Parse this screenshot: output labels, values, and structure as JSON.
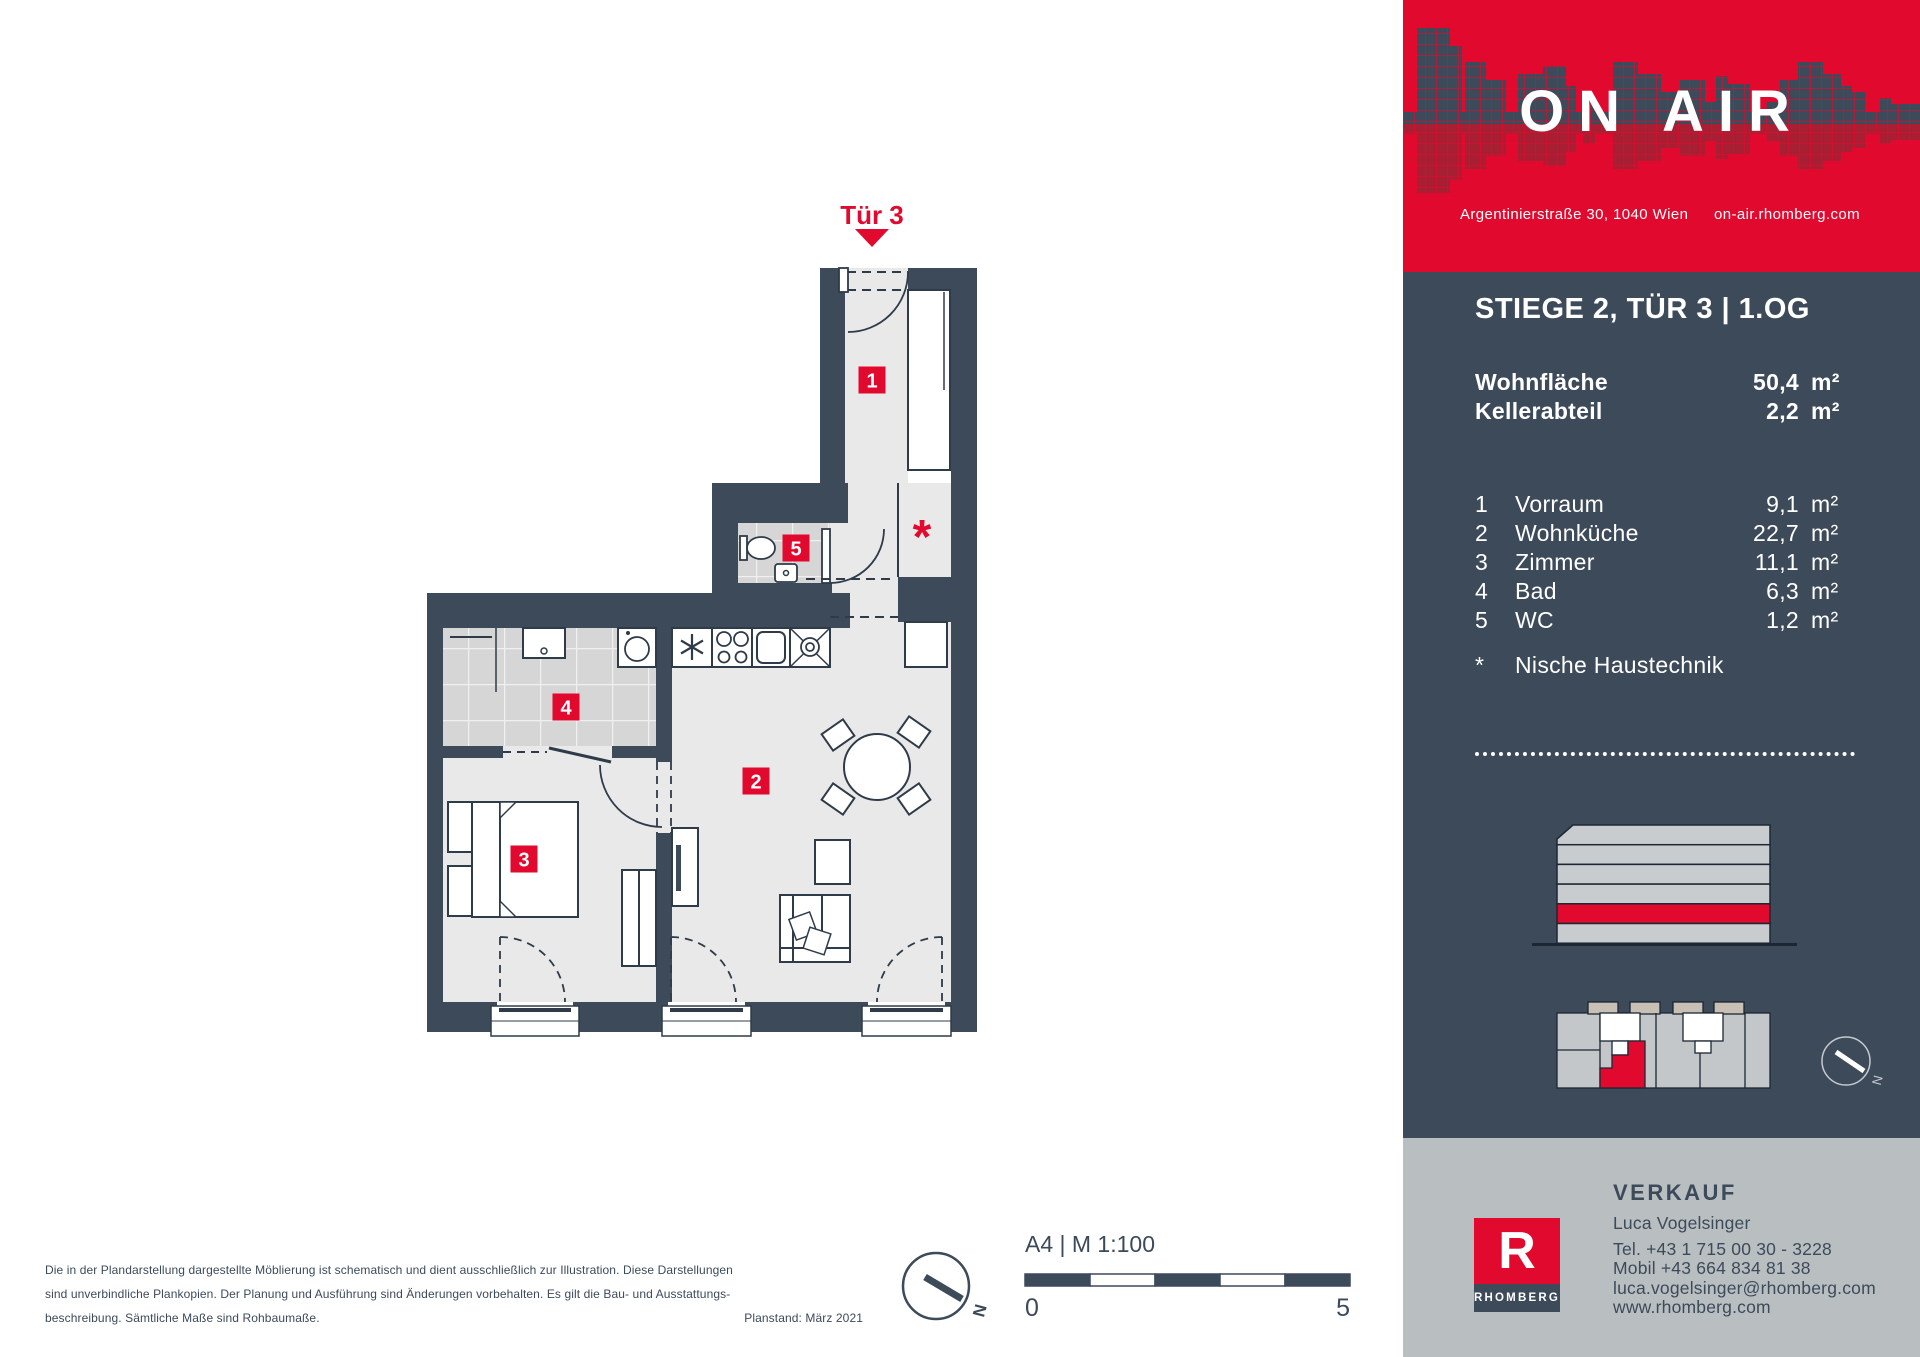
{
  "colors": {
    "accent_red": "#e2092e",
    "navy": "#3d4a5a",
    "reflection_red": "#a81f33",
    "floor_gray": "#e9e9e9",
    "tile_gray": "#d6d6d6",
    "footer_gray": "#b9bec1"
  },
  "header": {
    "brand": "ON AIR",
    "address": "Argentinierstraße 30, 1040 Wien",
    "website": "on-air.rhomberg.com"
  },
  "unit": {
    "title": "STIEGE 2, TÜR 3 | 1.OG",
    "summary": [
      {
        "label": "Wohnfläche",
        "value": "50,4",
        "unit": "m²"
      },
      {
        "label": "Kellerabteil",
        "value": "2,2",
        "unit": "m²"
      }
    ],
    "rooms": [
      {
        "nr": "1",
        "name": "Vorraum",
        "value": "9,1",
        "unit": "m²"
      },
      {
        "nr": "2",
        "name": "Wohnküche",
        "value": "22,7",
        "unit": "m²"
      },
      {
        "nr": "3",
        "name": "Zimmer",
        "value": "11,1",
        "unit": "m²"
      },
      {
        "nr": "4",
        "name": "Bad",
        "value": "6,3",
        "unit": "m²"
      },
      {
        "nr": "5",
        "name": "WC",
        "value": "1,2",
        "unit": "m²"
      }
    ],
    "note": {
      "symbol": "*",
      "text": "Nische Haustechnik"
    }
  },
  "plan": {
    "entrance_label": "Tür 3",
    "labels": {
      "room1": "1",
      "room2": "2",
      "room3": "3",
      "room4": "4",
      "room5": "5"
    },
    "niche_symbol": "*",
    "compass_label": "N"
  },
  "scalebar": {
    "title": "A4 | M 1:100",
    "start": "0",
    "end": "5"
  },
  "disclaimer": {
    "line1": "Die in der Plandarstellung dargestellte Möblierung ist schematisch und dient ausschließlich zur Illustration. Diese Darstellungen",
    "line2": "sind unverbindliche Plankopien. Der Planung und Ausführung sind Änderungen vorbehalten. Es gilt die Bau- und Ausstattungs-",
    "line3": "beschreibung. Sämtliche Maße sind Rohbaumaße.",
    "plan_date": "Planstand: März 2021"
  },
  "contact": {
    "heading": "VERKAUF",
    "name": "Luca Vogelsinger",
    "phone": "Tel. +43 1 715 00 30 - 3228",
    "mobile": "Mobil +43 664 834 81 38",
    "email": "luca.vogelsinger@rhomberg.com",
    "website": "www.rhomberg.com",
    "company": "RHOMBERG",
    "logo_letter": "R"
  }
}
